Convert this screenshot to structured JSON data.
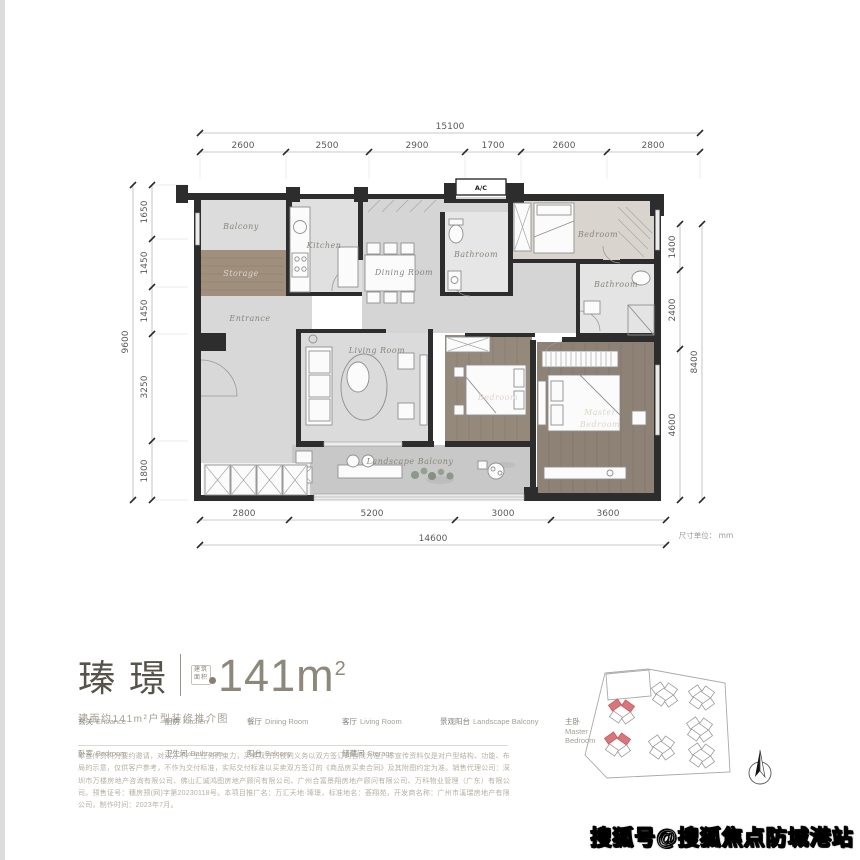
{
  "page": {
    "unit_note": "尺寸单位： mm",
    "watermark": "搜狐号@搜狐焦点防城港站"
  },
  "plan": {
    "ac_label": "A/C",
    "rooms": {
      "balcony": "Balcony",
      "storage": "Storage",
      "kitchen": "Kitchen",
      "dining": "Dining Room",
      "entrance": "Entrance",
      "bathroom1": "Bathroom",
      "bedroom1": "Bedroom",
      "bathroom2": "Bathroom",
      "living": "Living Room",
      "bedroom2": "Bedroom",
      "master_line1": "Master",
      "master_line2": "Bedroom",
      "landscape": "Landscape Balcony"
    },
    "dims": {
      "top_total": "15100",
      "top_segments": [
        "2600",
        "2500",
        "2900",
        "1700",
        "2600",
        "2800"
      ],
      "left_total": "9600",
      "left_segments": [
        "1650",
        "1450",
        "1450",
        "3250",
        "1800"
      ],
      "right_total": "8400",
      "right_segments": [
        "1400",
        "2400",
        "4600"
      ],
      "bottom_total": "14600",
      "bottom_segments": [
        "2800",
        "5200",
        "3000",
        "3600"
      ]
    }
  },
  "title_block": {
    "name": "瑧璟",
    "badge_line1": "建筑",
    "badge_line2": "面积",
    "area_number": "141m",
    "area_sup": "2",
    "subtitle": "建面约141m²户型装修推介图"
  },
  "legend": {
    "row1": [
      {
        "zh": "玄关",
        "en": "Entrance"
      },
      {
        "zh": "厨房",
        "en": "Kitchen"
      },
      {
        "zh": "餐厅",
        "en": "Dining Room"
      },
      {
        "zh": "客厅",
        "en": "Living Room"
      },
      {
        "zh": "景观阳台",
        "en": "Landscape Balcony"
      },
      {
        "zh": "主卧",
        "en": "Master Bedroom"
      }
    ],
    "row2": [
      {
        "zh": "卧室",
        "en": "Bedroom"
      },
      {
        "zh": "卫生间",
        "en": "Bathroom"
      },
      {
        "zh": "阳台",
        "en": "Balcony"
      },
      {
        "zh": "储藏间",
        "en": "Storage"
      }
    ]
  },
  "disclaimer": "本宣传资料为要约邀请，对双方不产生任何约束力，买卖双方的权利义务以双方签订的合同为准。本宣传资料仅是对户型结构、功能、布局的示意，仅供客户参考，不作为交付标准，实际交付标准以买卖双方签订的《商品房买卖合同》及其附图约定为准。销售代理公司：深圳市万楼房地产咨询有限公司、佛山汇诚鸿图房地产顾问有限公司、广州合富景翔房地产顾问有限公司、万科物业管理（广东）有限公司。预售证号：穗房预(网)字第20230118号。本项目推广名：万汇天地·瑧璟，标准地名：荟翔苑，开发商名称：广州市溪瑞房地产有限公司，制作时间：2023年7月。"
}
